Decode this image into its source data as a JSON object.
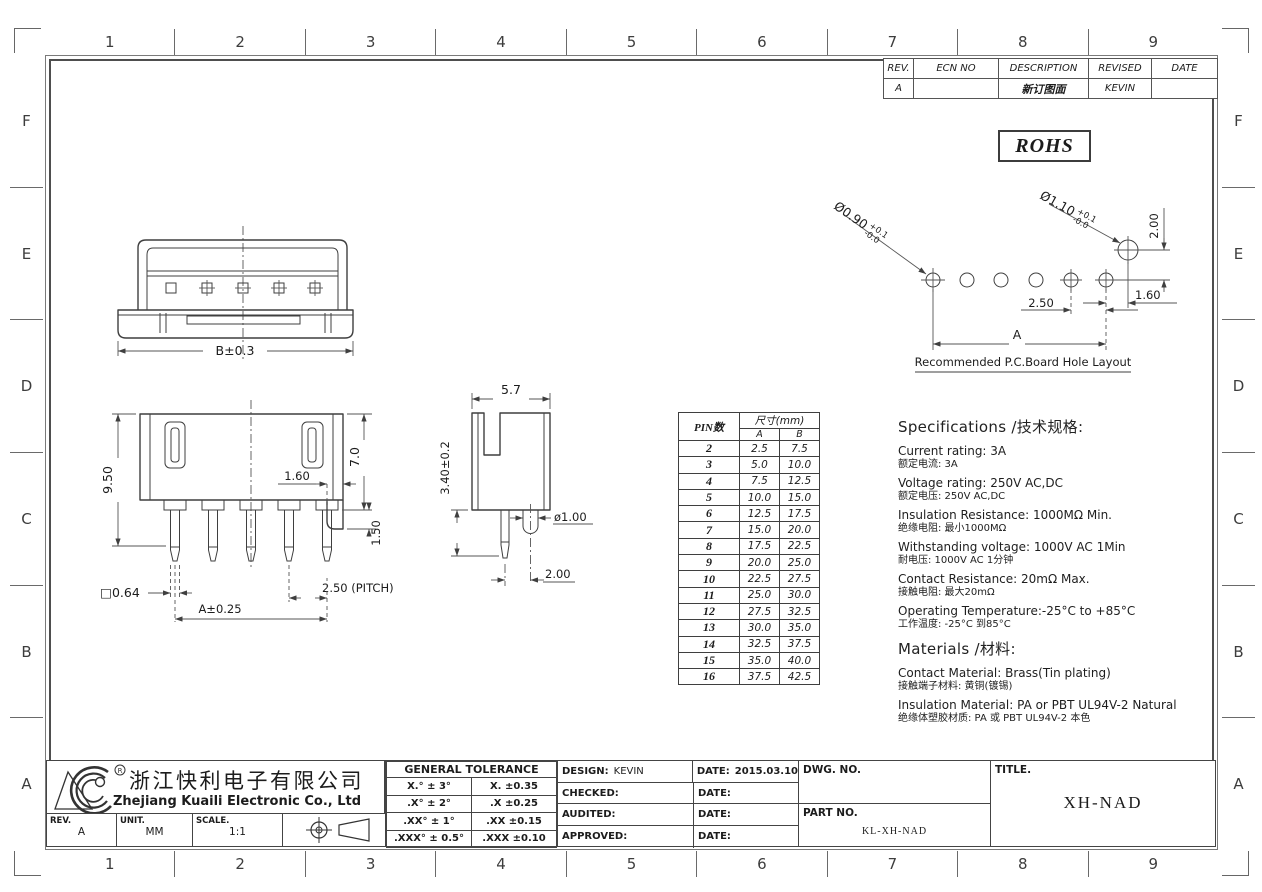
{
  "border": {
    "cols": [
      "1",
      "2",
      "3",
      "4",
      "5",
      "6",
      "7",
      "8",
      "9"
    ],
    "rows": [
      "F",
      "E",
      "D",
      "C",
      "B",
      "A"
    ]
  },
  "revision": {
    "headers": [
      "REV.",
      "ECN NO",
      "DESCRIPTION",
      "REVISED",
      "DATE"
    ],
    "row": {
      "rev": "A",
      "ecn": "",
      "desc": "新订图面",
      "revised": "KEVIN",
      "date": ""
    }
  },
  "rohs": "ROHS",
  "pcb": {
    "title": "Recommended P.C.Board Hole Layout",
    "hole_small": "Ø0.90",
    "hole_big": "Ø1.10",
    "tol_plus": "+0.1",
    "tol_minus": "-0.0",
    "dim_vert": "2.00",
    "dim_edge": "1.60",
    "dim_pitch": "2.50",
    "dim_span": "A"
  },
  "pin_table": {
    "header_pins": "PIN数",
    "header_size": "尺寸(mm)",
    "header_a": "A",
    "header_b": "B",
    "rows": [
      [
        "2",
        "2.5",
        "7.5"
      ],
      [
        "3",
        "5.0",
        "10.0"
      ],
      [
        "4",
        "7.5",
        "12.5"
      ],
      [
        "5",
        "10.0",
        "15.0"
      ],
      [
        "6",
        "12.5",
        "17.5"
      ],
      [
        "7",
        "15.0",
        "20.0"
      ],
      [
        "8",
        "17.5",
        "22.5"
      ],
      [
        "9",
        "20.0",
        "25.0"
      ],
      [
        "10",
        "22.5",
        "27.5"
      ],
      [
        "11",
        "25.0",
        "30.0"
      ],
      [
        "12",
        "27.5",
        "32.5"
      ],
      [
        "13",
        "30.0",
        "35.0"
      ],
      [
        "14",
        "32.5",
        "37.5"
      ],
      [
        "15",
        "35.0",
        "40.0"
      ],
      [
        "16",
        "37.5",
        "42.5"
      ]
    ]
  },
  "specifications": {
    "title": "Specifications /技术规格:",
    "items": [
      {
        "en": "Current rating: 3A",
        "zh": "额定电流: 3A"
      },
      {
        "en": "Voltage rating: 250V AC,DC",
        "zh": "额定电压: 250V AC,DC"
      },
      {
        "en": "Insulation Resistance: 1000MΩ Min.",
        "zh": "绝缘电阻: 最小1000MΩ"
      },
      {
        "en": "Withstanding voltage: 1000V AC 1Min",
        "zh": "耐电压: 1000V AC 1分钟"
      },
      {
        "en": "Contact Resistance: 20mΩ Max.",
        "zh": "接触电阻: 最大20mΩ"
      },
      {
        "en": "Operating Temperature:-25°C to +85°C",
        "zh": "工作温度: -25°C 到85°C"
      }
    ]
  },
  "materials": {
    "title": "Materials /材料:",
    "items": [
      {
        "en": "Contact Material: Brass(Tin plating)",
        "zh": "接触端子材料: 黄铜(镀锡)"
      },
      {
        "en": "Insulation Material: PA or PBT UL94V-2 Natural",
        "zh": "绝缘体塑胶材质: PA 或 PBT UL94V-2 本色"
      }
    ]
  },
  "views": {
    "top": {
      "dim_b": "B±0.3"
    },
    "front": {
      "dim_height": "9.50",
      "dim_housing": "7.0",
      "dim_gap": "1.60",
      "dim_foot": "1.50",
      "dim_pin": "□0.64",
      "dim_pitch": "2.50 (PITCH)",
      "dim_span": "A±0.25"
    },
    "side": {
      "dim_width": "5.7",
      "dim_tail": "3.40±0.2",
      "dim_boss": "ø1.00",
      "dim_offset": "2.00"
    }
  },
  "title_block": {
    "company_zh": "浙江快利电子有限公司",
    "company_en": "Zhejiang Kuaili Electronic Co., Ltd",
    "rev_label": "REV.",
    "rev_value": "A",
    "unit_label": "UNIT.",
    "unit_value": "MM",
    "scale_label": "SCALE.",
    "scale_value": "1:1",
    "tolerance_title": "GENERAL TOLERANCE",
    "tolerance_rows": [
      [
        "X.° ± 3°",
        "X. ±0.35"
      ],
      [
        ".X° ± 2°",
        ".X ±0.25"
      ],
      [
        ".XX° ± 1°",
        ".XX ±0.15"
      ],
      [
        ".XXX° ± 0.5°",
        ".XXX ±0.10"
      ]
    ],
    "signoff": [
      {
        "label": "DESIGN:",
        "value": "KEVIN",
        "date_label": "DATE:",
        "date_value": "2015.03.10"
      },
      {
        "label": "CHECKED:",
        "value": "",
        "date_label": "DATE:",
        "date_value": ""
      },
      {
        "label": "AUDITED:",
        "value": "",
        "date_label": "DATE:",
        "date_value": ""
      },
      {
        "label": "APPROVED:",
        "value": "",
        "date_label": "DATE:",
        "date_value": ""
      }
    ],
    "dwg_label": "DWG. NO.",
    "dwg_value": "",
    "part_label": "PART NO.",
    "part_value": "KL-XH-NAD",
    "title_label": "TITLE.",
    "title_value": "XH-NAD"
  }
}
